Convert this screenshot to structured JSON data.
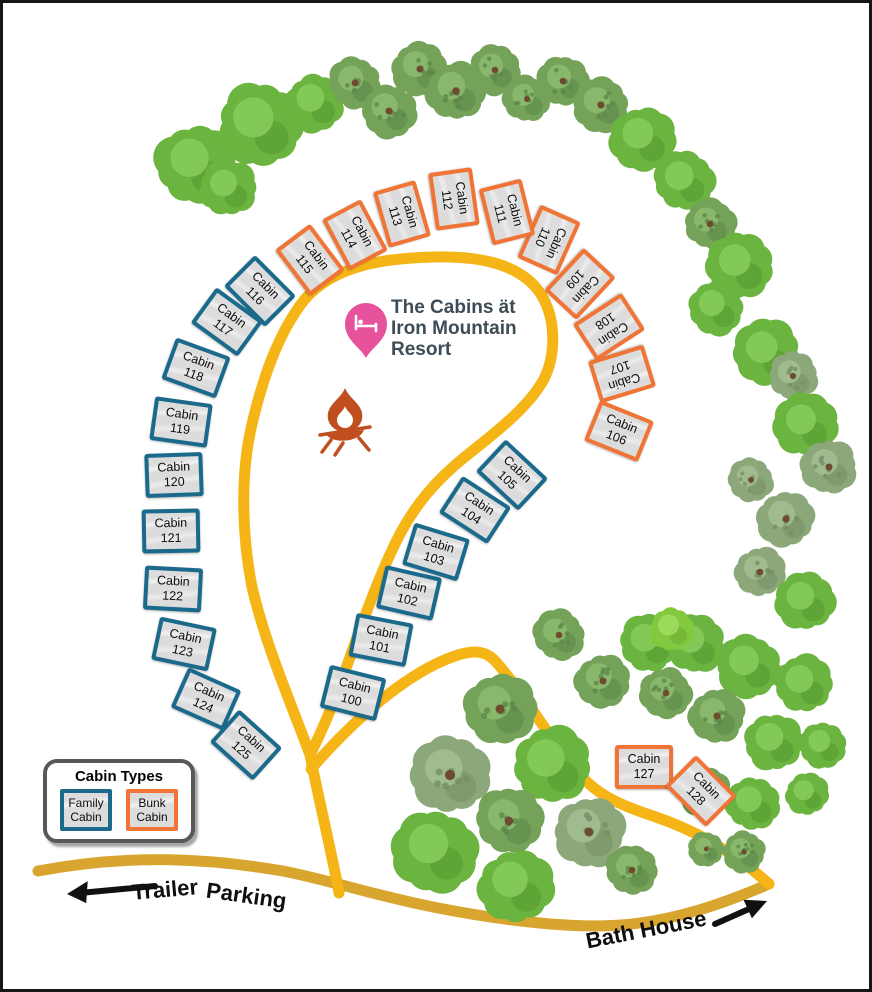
{
  "frame": {
    "width": 872,
    "height": 992
  },
  "title_block": {
    "icon": "map-pin-bed-icon",
    "lines": [
      "The Cabins ät",
      "Iron Mountain",
      "Resort"
    ]
  },
  "legend": {
    "title": "Cabin Types",
    "items": [
      {
        "line1": "Family",
        "line2": "Cabin",
        "type": "family"
      },
      {
        "line1": "Bunk",
        "line2": "Cabin",
        "type": "bunk"
      }
    ]
  },
  "labels": {
    "trailer_word1": "Trailer",
    "trailer_word2": "Parking",
    "bath_house": "Bath House"
  },
  "cabin_word": "Cabin",
  "colors": {
    "family": "#1B6A8C",
    "bunk": "#EF7435",
    "cabin_fill": "#DCDCDC",
    "road_main": "#F5B517",
    "road_entry": "#D8A62E",
    "campfire": "#C04E1E",
    "pin": "#E7529D",
    "arrow": "#111111",
    "title_color": "#3D4C55"
  },
  "cabins": [
    {
      "number": "100",
      "x": 350,
      "y": 690,
      "rot": 14,
      "type": "family"
    },
    {
      "number": "101",
      "x": 378,
      "y": 637,
      "rot": 11,
      "type": "family"
    },
    {
      "number": "102",
      "x": 406,
      "y": 590,
      "rot": 13,
      "type": "family"
    },
    {
      "number": "103",
      "x": 433,
      "y": 549,
      "rot": 17,
      "type": "family"
    },
    {
      "number": "104",
      "x": 472,
      "y": 507,
      "rot": 33,
      "type": "family"
    },
    {
      "number": "105",
      "x": 509,
      "y": 472,
      "rot": 43,
      "type": "family"
    },
    {
      "number": "106",
      "x": 616,
      "y": 428,
      "rot": 22,
      "type": "bunk"
    },
    {
      "number": "107",
      "x": 619,
      "y": 371,
      "rot": 163,
      "type": "bunk"
    },
    {
      "number": "108",
      "x": 606,
      "y": 324,
      "rot": 147,
      "type": "bunk"
    },
    {
      "number": "109",
      "x": 577,
      "y": 281,
      "rot": 133,
      "type": "bunk"
    },
    {
      "number": "110",
      "x": 546,
      "y": 237,
      "rot": 114,
      "type": "bunk"
    },
    {
      "number": "111",
      "x": 504,
      "y": 209,
      "rot": 76,
      "type": "bunk"
    },
    {
      "number": "112",
      "x": 451,
      "y": 196,
      "rot": 82,
      "type": "bunk"
    },
    {
      "number": "113",
      "x": 399,
      "y": 211,
      "rot": 74,
      "type": "bunk"
    },
    {
      "number": "114",
      "x": 352,
      "y": 232,
      "rot": 62,
      "type": "bunk"
    },
    {
      "number": "115",
      "x": 307,
      "y": 257,
      "rot": 53,
      "type": "bunk"
    },
    {
      "number": "116",
      "x": 257,
      "y": 288,
      "rot": 45,
      "type": "family"
    },
    {
      "number": "117",
      "x": 224,
      "y": 319,
      "rot": 36,
      "type": "family"
    },
    {
      "number": "118",
      "x": 193,
      "y": 365,
      "rot": 20,
      "type": "family"
    },
    {
      "number": "119",
      "x": 178,
      "y": 419,
      "rot": 8,
      "type": "family"
    },
    {
      "number": "120",
      "x": 171,
      "y": 472,
      "rot": -2,
      "type": "family"
    },
    {
      "number": "121",
      "x": 168,
      "y": 528,
      "rot": -1,
      "type": "family"
    },
    {
      "number": "122",
      "x": 170,
      "y": 586,
      "rot": 3,
      "type": "family"
    },
    {
      "number": "123",
      "x": 181,
      "y": 641,
      "rot": 12,
      "type": "family"
    },
    {
      "number": "124",
      "x": 203,
      "y": 696,
      "rot": 24,
      "type": "family"
    },
    {
      "number": "125",
      "x": 243,
      "y": 742,
      "rot": 42,
      "type": "family"
    },
    {
      "number": "127",
      "x": 641,
      "y": 764,
      "rot": 0,
      "type": "bunk"
    },
    {
      "number": "128",
      "x": 698,
      "y": 788,
      "rot": 45,
      "type": "bunk"
    }
  ],
  "roads": [
    {
      "name": "entry-road",
      "color": "#D8A62E",
      "width": 11,
      "d": "M 35 868 C 130 850 210 856 280 868 C 330 878 370 892 430 904 C 490 916 565 926 618 922 C 672 918 722 900 766 881"
    },
    {
      "name": "loop-tail-road",
      "color": "#F5B517",
      "width": 11,
      "d": "M 336 890 C 330 856 317 802 307 752"
    },
    {
      "name": "loop-road",
      "color": "#F5B517",
      "width": 11,
      "d": "M 307 752 C 290 705 263 644 249 584 C 239 533 237 472 249 421 C 259 379 274 331 302 296 C 332 262 382 255 432 254 C 482 253 521 263 539 293 C 553 317 553 352 541 376 C 525 405 493 429 463 453 C 433 477 413 501 397 531 C 377 569 357 626 341 671 C 327 711 314 738 307 752 Z"
    },
    {
      "name": "bath-house-road",
      "color": "#F5B517",
      "width": 11,
      "d": "M 308 766 C 348 720 402 670 452 653 C 472 646 484 648 494 660 C 520 690 546 734 572 766 C 592 791 614 801 650 813 C 692 827 732 850 766 881"
    }
  ],
  "trees": [
    [
      193,
      162,
      40,
      "b"
    ],
    [
      225,
      185,
      28,
      "b"
    ],
    [
      257,
      122,
      42,
      "b"
    ],
    [
      312,
      100,
      29,
      "b"
    ],
    [
      352,
      80,
      26,
      "t"
    ],
    [
      386,
      108,
      27,
      "t"
    ],
    [
      417,
      66,
      27,
      "t"
    ],
    [
      453,
      88,
      29,
      "t"
    ],
    [
      492,
      67,
      25,
      "t"
    ],
    [
      524,
      96,
      23,
      "t"
    ],
    [
      560,
      78,
      25,
      "t"
    ],
    [
      598,
      102,
      27,
      "t"
    ],
    [
      640,
      136,
      32,
      "b"
    ],
    [
      681,
      178,
      30,
      "b"
    ],
    [
      707,
      221,
      25,
      "t"
    ],
    [
      737,
      263,
      33,
      "b"
    ],
    [
      713,
      305,
      27,
      "b"
    ],
    [
      764,
      350,
      33,
      "b"
    ],
    [
      790,
      373,
      24,
      "s"
    ],
    [
      803,
      422,
      31,
      "b"
    ],
    [
      826,
      464,
      27,
      "s"
    ],
    [
      748,
      477,
      22,
      "s"
    ],
    [
      783,
      516,
      28,
      "s"
    ],
    [
      757,
      569,
      25,
      "s"
    ],
    [
      802,
      598,
      29,
      "b"
    ],
    [
      692,
      641,
      29,
      "b"
    ],
    [
      746,
      663,
      31,
      "b"
    ],
    [
      801,
      681,
      29,
      "b"
    ],
    [
      663,
      690,
      25,
      "t"
    ],
    [
      714,
      713,
      27,
      "t"
    ],
    [
      771,
      739,
      29,
      "b"
    ],
    [
      820,
      742,
      23,
      "b"
    ],
    [
      702,
      789,
      25,
      "t"
    ],
    [
      750,
      801,
      27,
      "b"
    ],
    [
      804,
      791,
      21,
      "b"
    ],
    [
      741,
      849,
      21,
      "t"
    ],
    [
      703,
      846,
      17,
      "t"
    ],
    [
      556,
      632,
      25,
      "t"
    ],
    [
      600,
      678,
      27,
      "t"
    ],
    [
      646,
      640,
      29,
      "b"
    ],
    [
      669,
      626,
      22,
      "l"
    ],
    [
      497,
      706,
      35,
      "t"
    ],
    [
      447,
      772,
      39,
      "s"
    ],
    [
      549,
      762,
      39,
      "b"
    ],
    [
      506,
      818,
      33,
      "t"
    ],
    [
      432,
      848,
      41,
      "b"
    ],
    [
      513,
      883,
      37,
      "b"
    ],
    [
      586,
      829,
      35,
      "s"
    ],
    [
      629,
      867,
      25,
      "t"
    ]
  ]
}
